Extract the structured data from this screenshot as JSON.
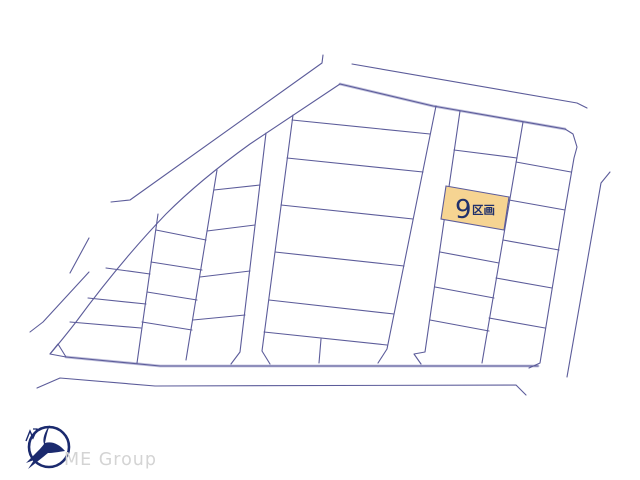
{
  "page": {
    "background_color": "#ffffff"
  },
  "map": {
    "type": "land-subdivision-plot-map",
    "highlighted_lot": {
      "number": "9",
      "unit_label": "区画",
      "fill_color": "#f6d492",
      "text_color": "#20306b"
    },
    "line_color": "#5c5c9a",
    "double_line_color": "#c0c0dc"
  },
  "branding": {
    "logo_text": "ME Group",
    "logo_color": "#1b2a6e",
    "logo_text_color": "#d4d4d4"
  }
}
